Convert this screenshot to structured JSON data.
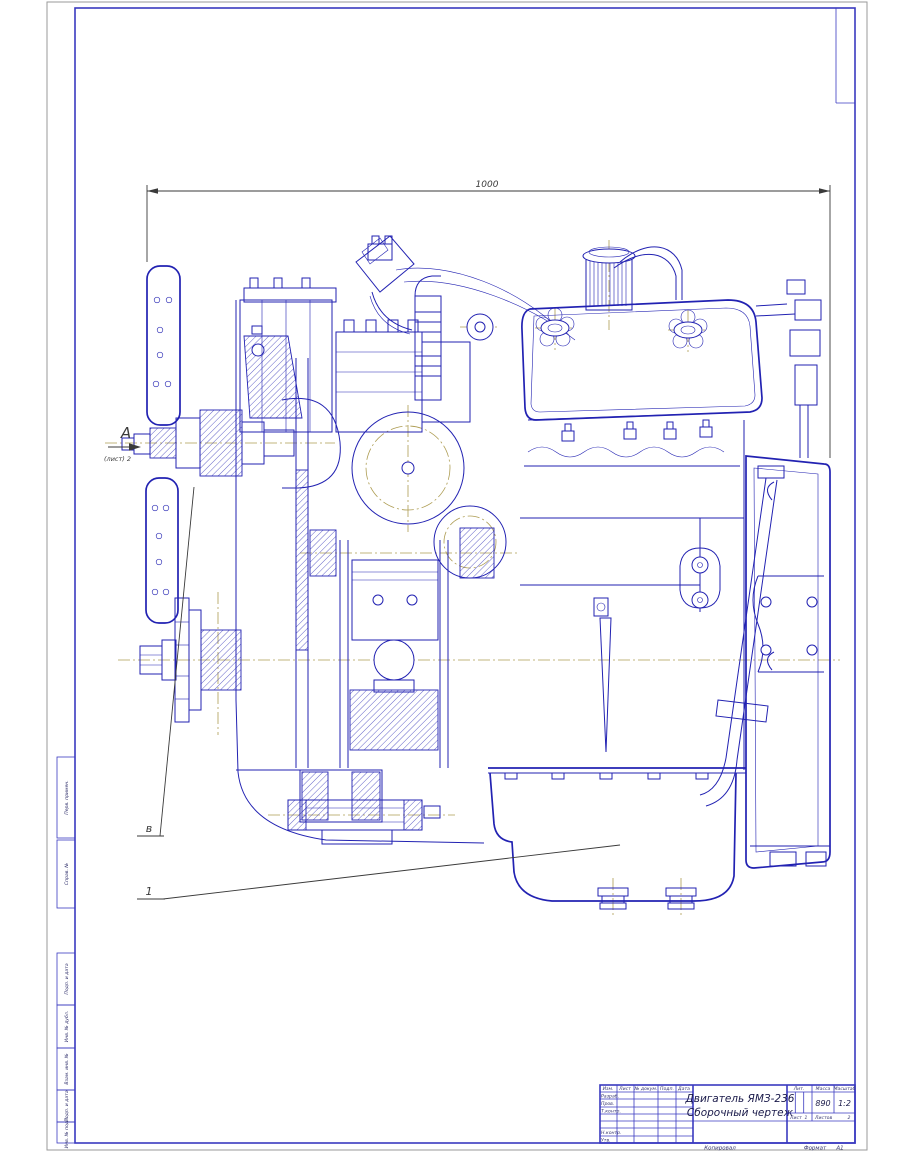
{
  "annotations": {
    "dimension_length": "1000",
    "view_letter": "А",
    "view_sheet_ref": "(лист) 2",
    "callout_v": "в",
    "callout_1": "1"
  },
  "side_stamps": [
    "Перв. примен.",
    "Справ. №",
    "Подп. и дата",
    "Инв. № дубл.",
    "Взам. инв. №",
    "Подп. и дата",
    "Инв. № подл."
  ],
  "title_block": {
    "title_line1": "Двигатель ЯМЗ-236",
    "title_line2": "Сборочный чертеж",
    "col_izm": "Изм.",
    "col_list": "Лист",
    "col_docnum": "№ докум.",
    "col_podp": "Подп.",
    "col_data": "Дата",
    "row_razrab": "Разраб.",
    "row_prov": "Пров.",
    "row_tkontr": "Т.контр.",
    "row_nkontr": "Н.контр.",
    "row_utv": "Утв.",
    "lit_label": "Лит.",
    "mass_label": "Масса",
    "scale_label": "Масштаб",
    "mass_value": "890",
    "scale_value": "1:2",
    "sheet_label": "Лист",
    "sheet_value": "1",
    "sheets_label": "Листов",
    "sheets_value": "2"
  },
  "footer": {
    "copied_label": "Копировал",
    "format_label": "Формат",
    "format_value": "А1"
  },
  "colors": {
    "line_blue": "#2222b2",
    "frame_blue": "#3a3ac0",
    "centerline_khaki": "#ad9c52",
    "annotation_gray": "#3a3a3a"
  }
}
